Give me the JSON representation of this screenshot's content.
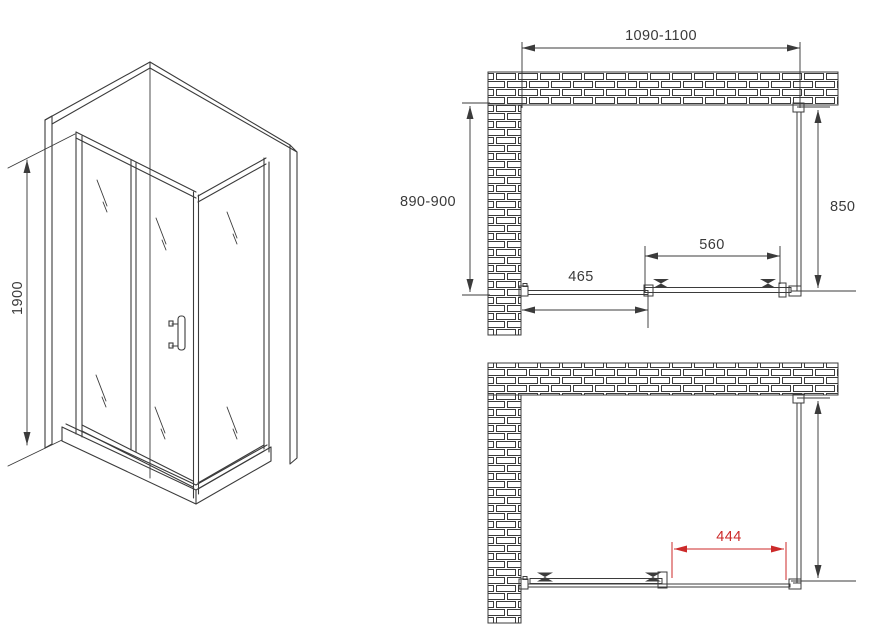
{
  "drawing": {
    "type": "shower-enclosure-installation-diagram",
    "colors": {
      "line": "#3b3b3b",
      "dim_red": "#cc2a2a",
      "background": "#ffffff"
    },
    "iso_view": {
      "height_label": "1900"
    },
    "plan_top": {
      "overall_width_label": "1090-1100",
      "overall_depth_label": "890-900",
      "side_panel_label": "850",
      "door_panel_label": "560",
      "fixed_panel_label": "465"
    },
    "plan_bottom": {
      "opening_width_label": "444"
    }
  }
}
